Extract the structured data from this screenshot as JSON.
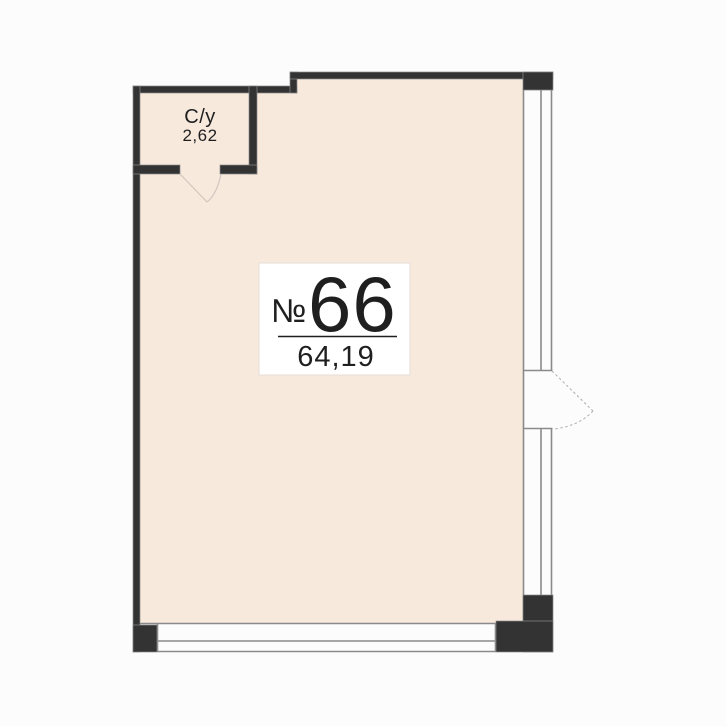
{
  "plan": {
    "unit": {
      "number_sign": "№",
      "number": "66",
      "area": "64,19"
    },
    "bathroom": {
      "name": "С/у",
      "area": "2,62"
    }
  },
  "icons": {
    "entry_door": "door-swing-arc",
    "bathroom_door": "door-swing-arc"
  },
  "colors": {
    "background": "#fcfcfc",
    "floor": "#f8e9dd",
    "wall": "#333333",
    "wall-outline": "#8b8b8b",
    "window-line": "#8a8a8a",
    "door-swing": "#b3b3b3",
    "bathroom-swing": "#d0c7bf",
    "label-bg": "#ffffff",
    "label-border": "#e8e1da",
    "text": "#1f1f1f"
  }
}
